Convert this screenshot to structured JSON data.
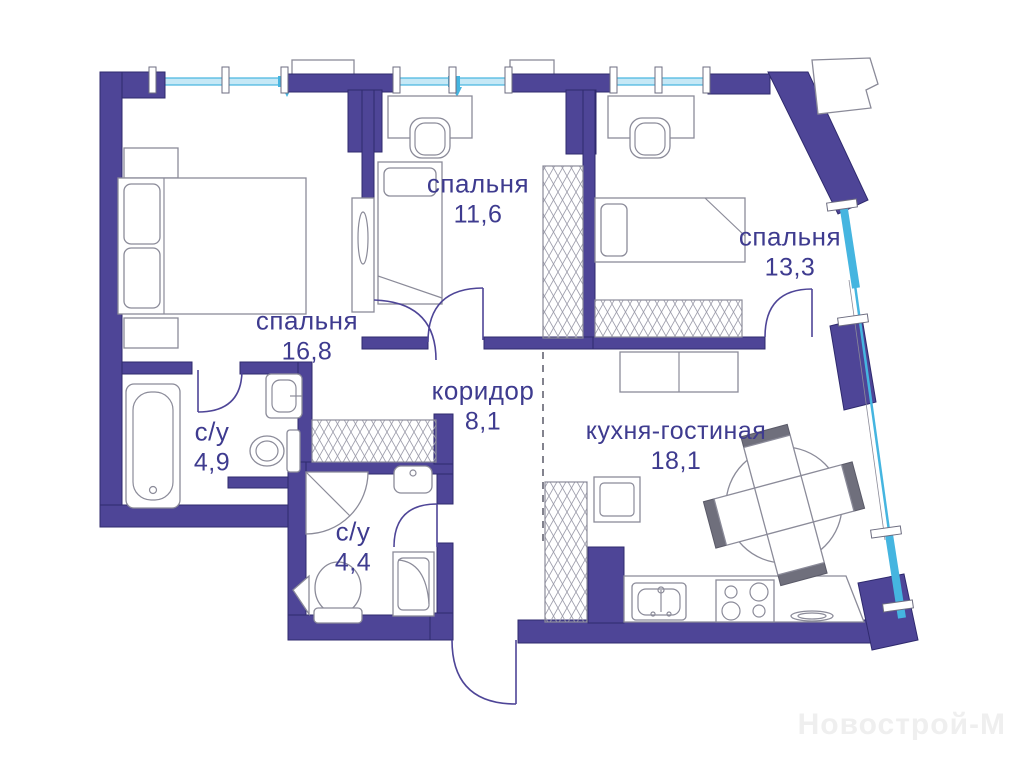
{
  "watermark": {
    "text": "Новострой-М"
  },
  "colors": {
    "wall": "#4e4597",
    "wall_outline": "#2f2a6e",
    "window": "#45b5e0",
    "window_light": "#c5e8f6",
    "furniture": "#8b8b99",
    "label": "#3e3b8f",
    "watermark": "#efefef"
  },
  "rooms": [
    {
      "name": "спальня",
      "area": "11,6"
    },
    {
      "name": "спальня",
      "area": "13,3"
    },
    {
      "name": "спальня",
      "area": "16,8"
    },
    {
      "name": "коридор",
      "area": "8,1"
    },
    {
      "name": "кухня-гостиная",
      "area": "18,1"
    },
    {
      "name": "с/у",
      "area": "4,9"
    },
    {
      "name": "с/у",
      "area": "4,4"
    }
  ]
}
